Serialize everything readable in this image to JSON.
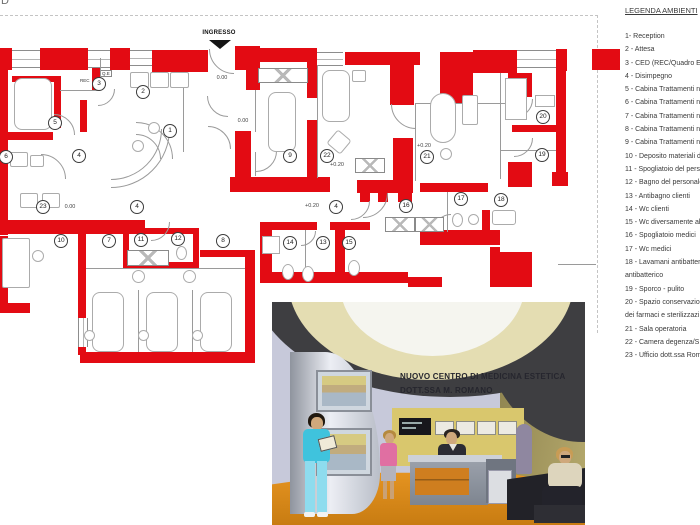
{
  "page": {
    "corner_char": "D"
  },
  "plan": {
    "entrance_label": "INGRESSO",
    "rec_label": "REC",
    "qe_label": "Q.E",
    "wall_color": "#e30b13",
    "rooms": [
      {
        "n": "1",
        "x": 170,
        "y": 131
      },
      {
        "n": "2",
        "x": 143,
        "y": 92
      },
      {
        "n": "3",
        "x": 99,
        "y": 84
      },
      {
        "n": "4",
        "x": 79,
        "y": 156
      },
      {
        "n": "4",
        "x": 137,
        "y": 207
      },
      {
        "n": "4",
        "x": 336,
        "y": 207
      },
      {
        "n": "5",
        "x": 55,
        "y": 123
      },
      {
        "n": "6",
        "x": 6,
        "y": 157
      },
      {
        "n": "7",
        "x": 109,
        "y": 241
      },
      {
        "n": "8",
        "x": 223,
        "y": 241
      },
      {
        "n": "9",
        "x": 290,
        "y": 156
      },
      {
        "n": "10",
        "x": 61,
        "y": 241
      },
      {
        "n": "11",
        "x": 141,
        "y": 240
      },
      {
        "n": "12",
        "x": 178,
        "y": 239
      },
      {
        "n": "13",
        "x": 323,
        "y": 243
      },
      {
        "n": "14",
        "x": 290,
        "y": 243
      },
      {
        "n": "15",
        "x": 349,
        "y": 243
      },
      {
        "n": "16",
        "x": 406,
        "y": 206
      },
      {
        "n": "17",
        "x": 461,
        "y": 199
      },
      {
        "n": "18",
        "x": 501,
        "y": 200
      },
      {
        "n": "19",
        "x": 542,
        "y": 155
      },
      {
        "n": "20",
        "x": 543,
        "y": 117
      },
      {
        "n": "21",
        "x": 427,
        "y": 157
      },
      {
        "n": "22",
        "x": 327,
        "y": 156
      },
      {
        "n": "23",
        "x": 43,
        "y": 207
      }
    ],
    "levels": [
      {
        "t": "0.00",
        "x": 222,
        "y": 78
      },
      {
        "t": "0.00",
        "x": 243,
        "y": 121
      },
      {
        "t": "0.00",
        "x": 70,
        "y": 207
      },
      {
        "t": "+0.20",
        "x": 424,
        "y": 146
      },
      {
        "t": "+0.20",
        "x": 337,
        "y": 165
      },
      {
        "t": "+0.20",
        "x": 312,
        "y": 206
      }
    ],
    "walls": [
      [
        0,
        48,
        12,
        22
      ],
      [
        40,
        48,
        48,
        22
      ],
      [
        110,
        48,
        20,
        22
      ],
      [
        152,
        50,
        56,
        22
      ],
      [
        235,
        46,
        25,
        24
      ],
      [
        246,
        60,
        14,
        30
      ],
      [
        260,
        48,
        47,
        14
      ],
      [
        307,
        48,
        10,
        50
      ],
      [
        345,
        52,
        75,
        13
      ],
      [
        390,
        60,
        24,
        45
      ],
      [
        440,
        52,
        33,
        51
      ],
      [
        473,
        50,
        44,
        23
      ],
      [
        556,
        49,
        11,
        22
      ],
      [
        592,
        49,
        28,
        21
      ],
      [
        556,
        60,
        10,
        120
      ],
      [
        508,
        73,
        24,
        24
      ],
      [
        512,
        125,
        46,
        7
      ],
      [
        508,
        162,
        24,
        25
      ],
      [
        552,
        172,
        16,
        14
      ],
      [
        420,
        183,
        68,
        9
      ],
      [
        420,
        230,
        80,
        15
      ],
      [
        490,
        247,
        10,
        40
      ],
      [
        495,
        252,
        37,
        35
      ],
      [
        482,
        210,
        8,
        28
      ],
      [
        307,
        120,
        10,
        57
      ],
      [
        235,
        131,
        16,
        47
      ],
      [
        230,
        177,
        100,
        15
      ],
      [
        393,
        138,
        20,
        55
      ],
      [
        357,
        180,
        56,
        13
      ],
      [
        360,
        193,
        10,
        9
      ],
      [
        378,
        193,
        10,
        9
      ],
      [
        398,
        193,
        14,
        9
      ],
      [
        0,
        70,
        8,
        165
      ],
      [
        5,
        132,
        48,
        8
      ],
      [
        54,
        76,
        7,
        52
      ],
      [
        12,
        76,
        42,
        6
      ],
      [
        80,
        100,
        7,
        32
      ],
      [
        92,
        58,
        8,
        32
      ],
      [
        93,
        70,
        5,
        5
      ],
      [
        0,
        220,
        145,
        14
      ],
      [
        0,
        236,
        8,
        70
      ],
      [
        0,
        303,
        30,
        10
      ],
      [
        123,
        228,
        76,
        6
      ],
      [
        123,
        228,
        6,
        40
      ],
      [
        193,
        228,
        6,
        40
      ],
      [
        123,
        262,
        76,
        6
      ],
      [
        200,
        250,
        55,
        7
      ],
      [
        78,
        232,
        8,
        88
      ],
      [
        78,
        347,
        8,
        8
      ],
      [
        80,
        352,
        175,
        11
      ],
      [
        245,
        252,
        10,
        111
      ],
      [
        260,
        222,
        57,
        8
      ],
      [
        330,
        222,
        40,
        8
      ],
      [
        260,
        222,
        12,
        50
      ],
      [
        335,
        230,
        10,
        42
      ],
      [
        260,
        272,
        148,
        11
      ],
      [
        408,
        277,
        34,
        10
      ]
    ],
    "windows": [
      [
        12,
        50,
        28,
        16,
        "h"
      ],
      [
        88,
        50,
        22,
        16,
        "h"
      ],
      [
        130,
        50,
        22,
        14,
        "h"
      ],
      [
        317,
        52,
        26,
        12,
        "h"
      ],
      [
        517,
        50,
        39,
        16,
        "h"
      ],
      [
        78,
        318,
        8,
        29,
        "v"
      ]
    ],
    "xboxes": [
      [
        258,
        68,
        48,
        13
      ],
      [
        127,
        250,
        40,
        14
      ],
      [
        355,
        158,
        28,
        13
      ],
      [
        385,
        217,
        28,
        13
      ],
      [
        415,
        217,
        27,
        13
      ]
    ],
    "lines": [
      [
        100,
        58,
        32,
        "v"
      ],
      [
        60,
        90,
        40,
        "h"
      ],
      [
        183,
        88,
        64,
        "v"
      ],
      [
        255,
        90,
        42,
        "v"
      ],
      [
        255,
        152,
        24,
        "v"
      ],
      [
        317,
        65,
        113,
        "v"
      ],
      [
        415,
        103,
        78,
        "v"
      ],
      [
        415,
        103,
        90,
        "h"
      ],
      [
        500,
        73,
        106,
        "v"
      ],
      [
        500,
        150,
        56,
        "h"
      ],
      [
        447,
        192,
        40,
        "v"
      ],
      [
        86,
        268,
        159,
        "h"
      ],
      [
        138,
        290,
        62,
        "v"
      ],
      [
        192,
        290,
        62,
        "v"
      ],
      [
        305,
        230,
        42,
        "v"
      ],
      [
        558,
        264,
        38,
        "h"
      ]
    ],
    "arcs": [
      [
        233,
        48,
        24,
        "bl"
      ],
      [
        110,
        128,
        50,
        "br"
      ],
      [
        110,
        128,
        58,
        "br"
      ],
      [
        135,
        158,
        36,
        "tr"
      ],
      [
        135,
        158,
        24,
        "tr"
      ],
      [
        227,
        95,
        20,
        "bl"
      ],
      [
        207,
        148,
        22,
        "tr"
      ],
      [
        40,
        178,
        24,
        "tr"
      ],
      [
        53,
        134,
        20,
        "tr"
      ],
      [
        97,
        88,
        16,
        "br"
      ],
      [
        255,
        150,
        20,
        "br"
      ],
      [
        415,
        103,
        24,
        "bl"
      ],
      [
        362,
        192,
        24,
        "br"
      ],
      [
        513,
        98,
        18,
        "br"
      ],
      [
        513,
        137,
        18,
        "br"
      ],
      [
        150,
        221,
        18,
        "br"
      ],
      [
        350,
        200,
        18,
        "br"
      ],
      [
        300,
        230,
        14,
        "br"
      ],
      [
        450,
        230,
        16,
        "tl"
      ]
    ],
    "furniture": [
      [
        14,
        78,
        36,
        50,
        8,
        0
      ],
      [
        268,
        92,
        26,
        58,
        8,
        0
      ],
      [
        322,
        70,
        26,
        50,
        8,
        0
      ],
      [
        352,
        70,
        12,
        10,
        2,
        0
      ],
      [
        330,
        133,
        16,
        16,
        3,
        40
      ],
      [
        430,
        93,
        24,
        48,
        40,
        0
      ],
      [
        462,
        95,
        14,
        28,
        2,
        0
      ],
      [
        440,
        148,
        10,
        10,
        50,
        0
      ],
      [
        2,
        238,
        26,
        48,
        2,
        0
      ],
      [
        20,
        193,
        16,
        13,
        2,
        0
      ],
      [
        42,
        193,
        16,
        13,
        2,
        0
      ],
      [
        32,
        250,
        10,
        10,
        50,
        0
      ],
      [
        92,
        292,
        30,
        58,
        8,
        0
      ],
      [
        146,
        292,
        30,
        58,
        8,
        0
      ],
      [
        200,
        292,
        30,
        58,
        8,
        0
      ],
      [
        84,
        330,
        9,
        9,
        50,
        0
      ],
      [
        138,
        330,
        9,
        9,
        50,
        0
      ],
      [
        192,
        330,
        9,
        9,
        50,
        0
      ],
      [
        132,
        270,
        11,
        11,
        50,
        0
      ],
      [
        183,
        270,
        11,
        11,
        50,
        0
      ],
      [
        282,
        264,
        10,
        14,
        50,
        0
      ],
      [
        302,
        266,
        10,
        14,
        50,
        0
      ],
      [
        262,
        236,
        16,
        16,
        0,
        0
      ],
      [
        348,
        260,
        10,
        14,
        50,
        0
      ],
      [
        452,
        213,
        9,
        12,
        50,
        0
      ],
      [
        468,
        214,
        9,
        9,
        50,
        0
      ],
      [
        492,
        210,
        22,
        13,
        3,
        0
      ],
      [
        176,
        246,
        9,
        12,
        50,
        0
      ],
      [
        505,
        78,
        20,
        40,
        0,
        0
      ],
      [
        535,
        95,
        18,
        10,
        0,
        0
      ],
      [
        130,
        72,
        17,
        14,
        2,
        0
      ],
      [
        150,
        72,
        17,
        14,
        2,
        0
      ],
      [
        170,
        72,
        17,
        14,
        2,
        0
      ],
      [
        148,
        122,
        10,
        10,
        50,
        0
      ],
      [
        132,
        140,
        10,
        10,
        50,
        0
      ],
      [
        10,
        152,
        16,
        13,
        2,
        0
      ],
      [
        30,
        155,
        12,
        10,
        2,
        0
      ]
    ]
  },
  "legend": {
    "title": "LEGENDA AMBIENTI",
    "items": [
      "1- Reception",
      "2 - Attesa",
      "3 - CED (REC/Quadro E",
      "4 - Disimpegno",
      "5 - Cabina Trattamenti n",
      "6 - Cabina Trattamenti n",
      "7 - Cabina Trattamenti n",
      "8 - Cabina Trattamenti n",
      "9 - Cabina Trattamenti n",
      "10 - Deposito materiali d",
      "11 - Spogliatoio del pers",
      "12 - Bagno del personale",
      "13 - Antibagno clienti",
      "14 - Wc clienti",
      "15 - Wc diversamente ab",
      "16 - Spogliatoio medici",
      "17 -  Wc medici",
      "18 - Lavamani antibatter",
      "antibatterico",
      "19 - Sporco - pulito",
      "20 - Spazio conservazio",
      "dei farmaci e sterilizzazi",
      "21 - Sala operatoria",
      "22 - Camera degenza/S",
      "23 - Ufficio dott.ssa Rom"
    ]
  },
  "render": {
    "sign_line1": "NUOVO CENTRO DI MEDICINA ESTETICA",
    "sign_line2": "DOTT.SSA M. ROMANO",
    "colors": {
      "floor_orange": "#e08a1e",
      "scrubs_cyan": "#41c3dd",
      "wall_lavender": "#c7c9da",
      "wall_olive": "#ab9f62",
      "ceiling_cream": "#e4ddb2",
      "ceiling_dark": "#3e3e41",
      "accent_yellow_wall": "#d9c76d"
    }
  }
}
